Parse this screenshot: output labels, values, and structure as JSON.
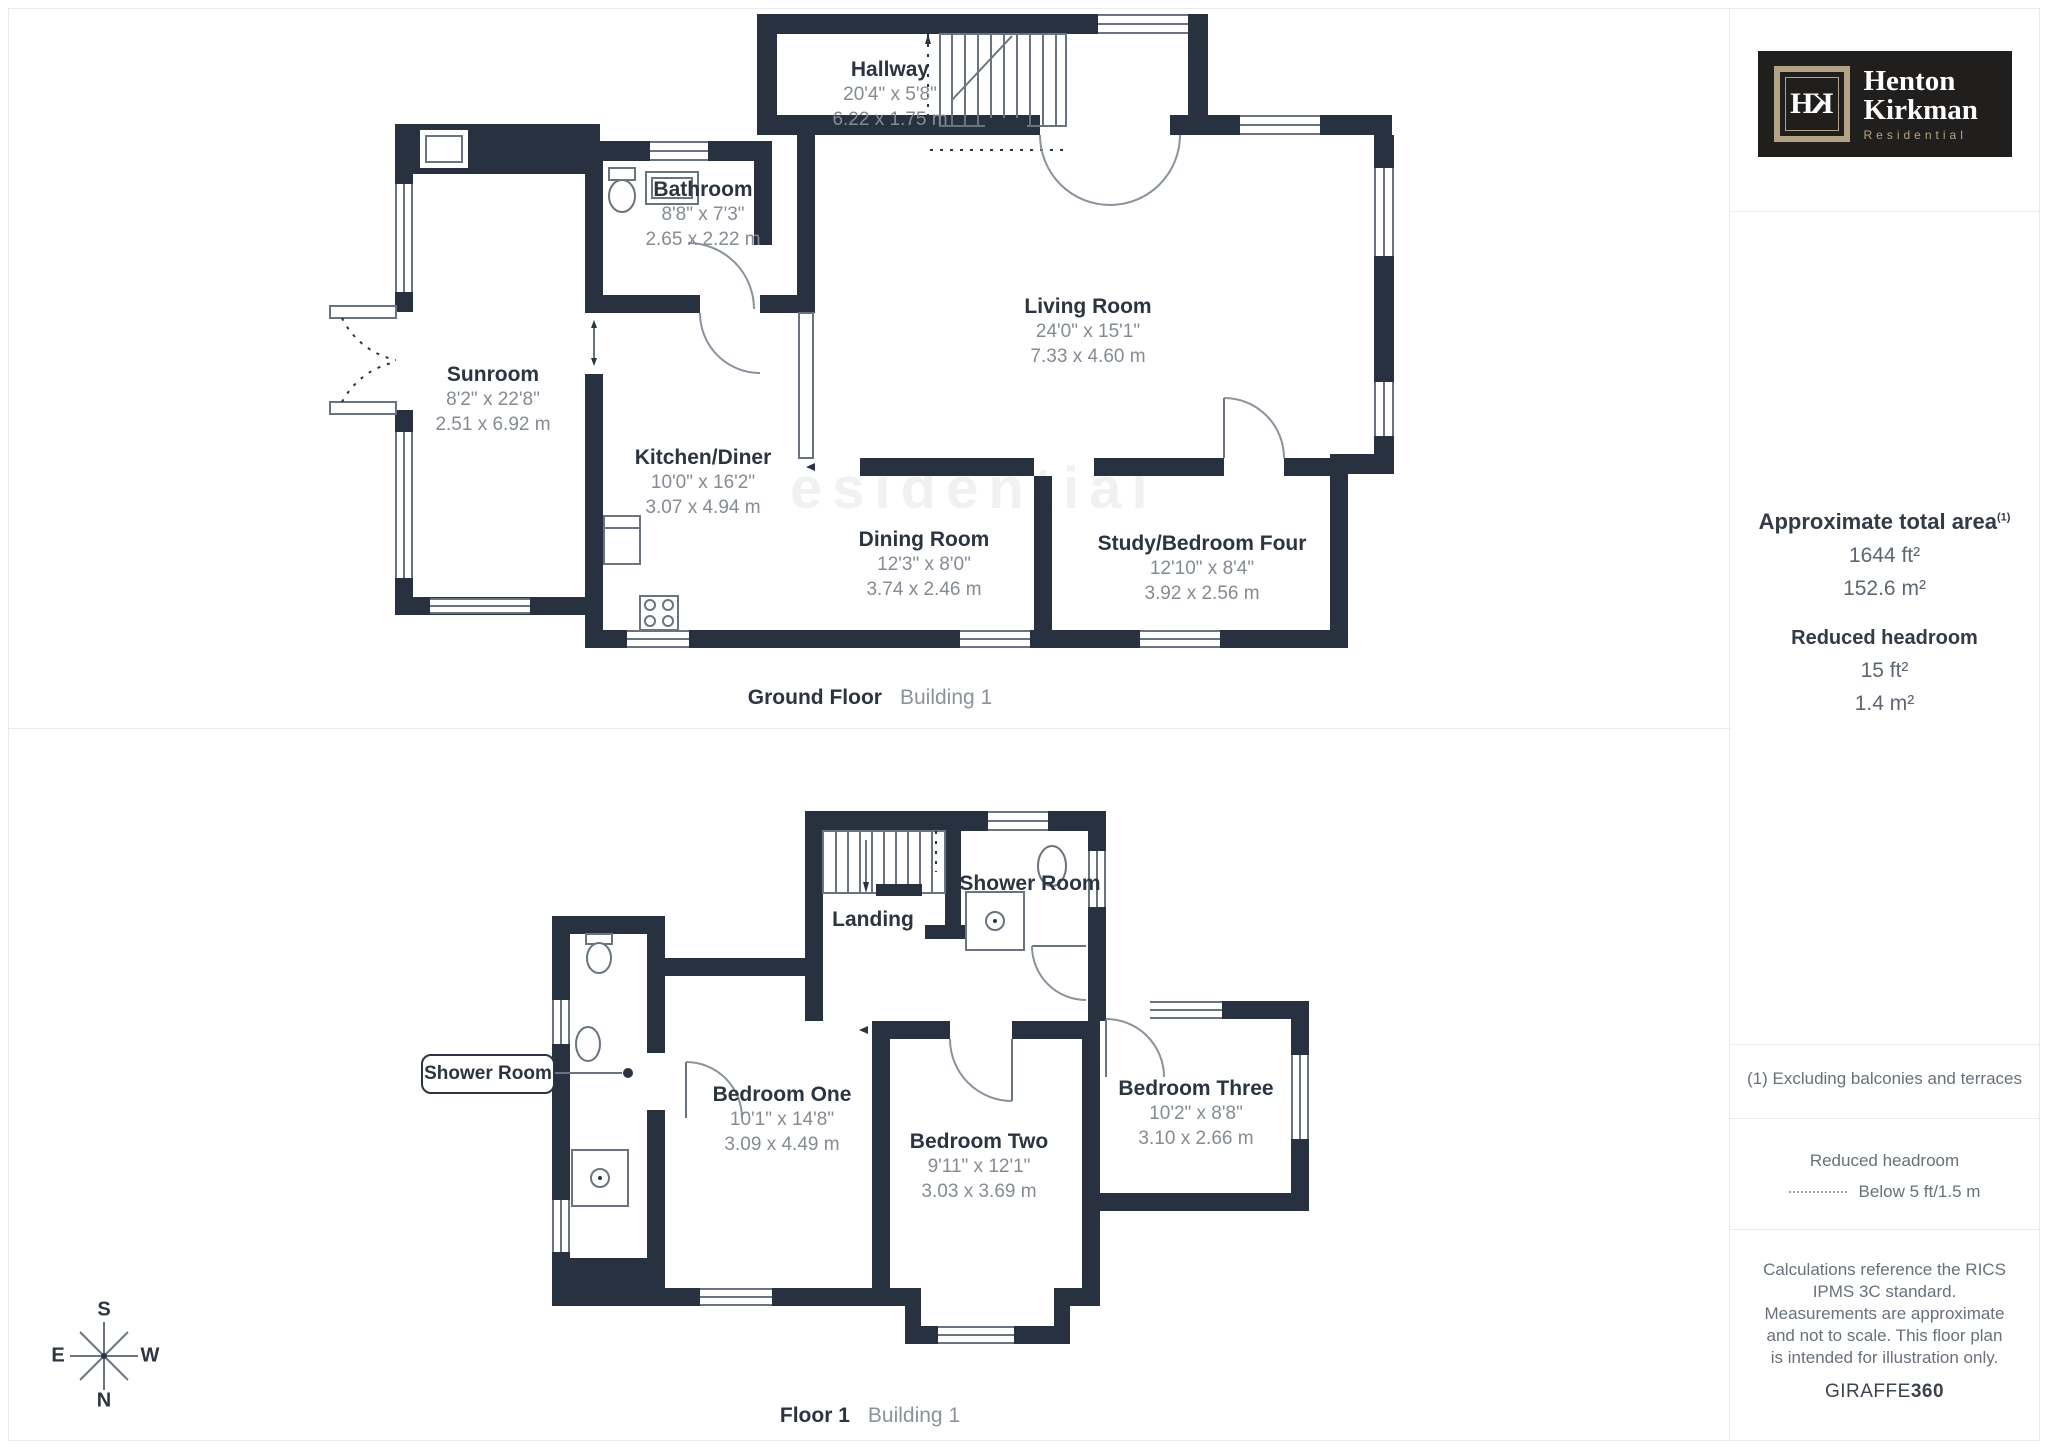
{
  "brand": {
    "monogram_h": "H",
    "monogram_k": "K",
    "name_line1": "Henton",
    "name_line2": "Kirkman",
    "tagline": "Residential",
    "colors": {
      "bg": "#211F1D",
      "accent": "#B3A386",
      "text": "#FFFFFF"
    }
  },
  "sidebar": {
    "total_area": {
      "heading": "Approximate total area",
      "footnote_marker": "(1)",
      "imperial": "1644 ft²",
      "metric": "152.6 m²"
    },
    "reduced_headroom": {
      "heading": "Reduced headroom",
      "imperial": "15 ft²",
      "metric": "1.4 m²"
    },
    "notes": {
      "footnote": "(1) Excluding balconies and terraces",
      "legend_title": "Reduced headroom",
      "legend_label": "Below 5 ft/1.5 m",
      "disclaimer": "Calculations reference the RICS IPMS 3C standard. Measurements are approximate and not to scale. This floor plan is intended for illustration only.",
      "credit_normal": "GIRAFFE",
      "credit_bold": "360"
    }
  },
  "floors": [
    {
      "caption_bold": "Ground Floor",
      "caption_light": "Building 1",
      "rooms": [
        {
          "name": "Hallway",
          "imperial": "20'4\" x 5'8\"",
          "metric": "6.22 x 1.75 m"
        },
        {
          "name": "Bathroom",
          "imperial": "8'8\" x 7'3\"",
          "metric": "2.65 x 2.22 m"
        },
        {
          "name": "Living Room",
          "imperial": "24'0\" x 15'1\"",
          "metric": "7.33 x 4.60 m"
        },
        {
          "name": "Sunroom",
          "imperial": "8'2\" x 22'8\"",
          "metric": "2.51 x 6.92 m"
        },
        {
          "name": "Kitchen/Diner",
          "imperial": "10'0\" x 16'2\"",
          "metric": "3.07 x 4.94 m"
        },
        {
          "name": "Dining Room",
          "imperial": "12'3\" x 8'0\"",
          "metric": "3.74 x 2.46 m"
        },
        {
          "name": "Study/Bedroom Four",
          "imperial": "12'10\" x 8'4\"",
          "metric": "3.92 x 2.56 m"
        }
      ]
    },
    {
      "caption_bold": "Floor 1",
      "caption_light": "Building 1",
      "rooms": [
        {
          "name": "Landing"
        },
        {
          "name": "Shower Room"
        },
        {
          "name": "Shower Room"
        },
        {
          "name": "Bedroom One",
          "imperial": "10'1\" x 14'8\"",
          "metric": "3.09 x 4.49 m"
        },
        {
          "name": "Bedroom Two",
          "imperial": "9'11\" x 12'1\"",
          "metric": "3.03 x 3.69 m"
        },
        {
          "name": "Bedroom Three",
          "imperial": "10'2\" x 8'8\"",
          "metric": "3.10 x 2.66 m"
        }
      ]
    }
  ],
  "compass": {
    "top": "S",
    "bottom": "N",
    "left": "E",
    "right": "W"
  },
  "watermark": "esidential",
  "colors": {
    "wall": "#283140",
    "label": "#2B3440",
    "dim": "#848B94",
    "border": "#EBEBEB"
  }
}
